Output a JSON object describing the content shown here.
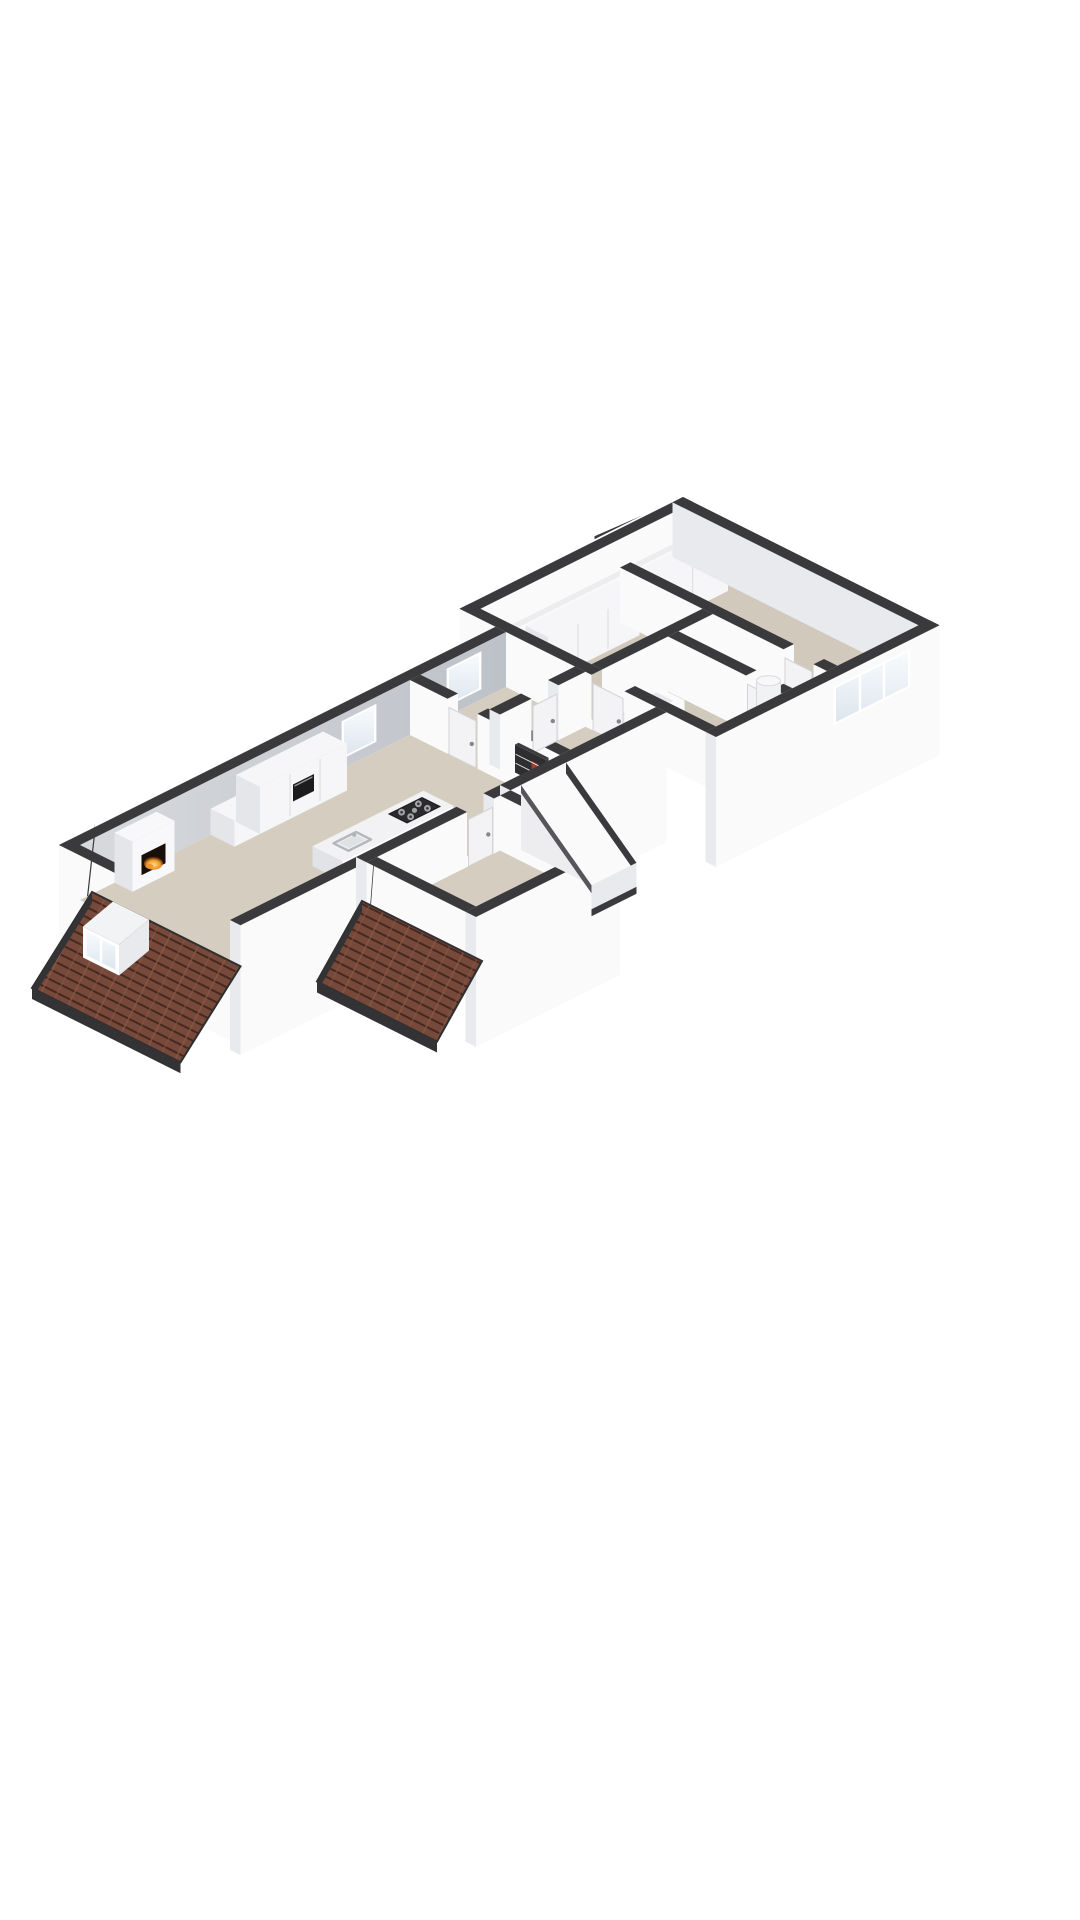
{
  "meta": {
    "figure_type": "3d-floor-plan-render",
    "view": "isometric-from-above",
    "background": "#ffffff",
    "visible_text": []
  },
  "scene": {
    "areas": [
      {
        "name": "living-room"
      },
      {
        "name": "kitchen"
      },
      {
        "name": "hallway"
      },
      {
        "name": "front-bedroom"
      },
      {
        "name": "right-wing-bedroom"
      },
      {
        "name": "bathroom"
      },
      {
        "name": "stair-void"
      },
      {
        "name": "entrance-porch"
      }
    ],
    "objects": [
      {
        "name": "fireplace",
        "detail": "white chimney breast with burning fire opening"
      },
      {
        "name": "kitchen-island",
        "detail": "white island with gas hob and sink"
      },
      {
        "name": "gas-hob",
        "detail": "dark cooktop with round burners"
      },
      {
        "name": "kitchen-sink",
        "detail": "inset sink with faucet"
      },
      {
        "name": "kitchen-cabinets",
        "detail": "tall white unit with built-in oven"
      },
      {
        "name": "built-in-oven",
        "detail": "black front"
      },
      {
        "name": "bathtub",
        "detail": "white tub on dark plinth"
      },
      {
        "name": "boiler",
        "detail": "white cylinder"
      },
      {
        "name": "wardrobes",
        "detail": "white closet runs in right wing"
      },
      {
        "name": "dormer-window",
        "detail": "white dormer on tiled roof"
      },
      {
        "name": "bedroom-window",
        "detail": "triple-pane window in right wing"
      },
      {
        "name": "roof-slopes",
        "detail": "two brown shingled roof slopes"
      },
      {
        "name": "interior-doors",
        "detail": "white panels with handles"
      }
    ]
  },
  "colors": {
    "background": "#ffffff",
    "wallCap": "#3a3a3d",
    "wallWhite": "#fafafb",
    "wallShaded": "#e9eaed",
    "wallGradA": "#d8dade",
    "wallGradB": "#bdc1c8",
    "floorMain": "#d4cdc0",
    "floorWing": "#d0c9bc",
    "voidDark": "#74757a",
    "roofBase": "#76493a",
    "roofStripe": "#45291f",
    "roofRidge": "#8a5845",
    "roofEave": "#333335",
    "glassA": "#dde6ee",
    "glassB": "#f8fbfd",
    "frameWhite": "#ffffff",
    "cabinet": "#f6f6f8",
    "cabinetSide": "#e5e6e9",
    "seam": "#dfe0e3",
    "ovenDark": "#1c1c1e",
    "islandTop": "#f2f2f4",
    "islandSide": "#e2e3e7",
    "hobDark": "#2b2b2e",
    "burnerGray": "#a0a2a7",
    "sinkGray": "#b4b7bc",
    "tubWhite": "#fbfbfc",
    "tubInner": "#e7e9ec",
    "fireplaceWhite": "#f8f8fa",
    "fireBoxDark": "#190f08",
    "fireCore": "#ffe289",
    "fireOrange": "#ef9426",
    "fireDeep": "#8a3a0a",
    "doorWhite": "#f3f3f5",
    "doorHandle": "#85878c",
    "boilerWhite": "#f1f2f4",
    "bookRed": "#a33b2e",
    "shelfDark": "#3c3c3e"
  }
}
